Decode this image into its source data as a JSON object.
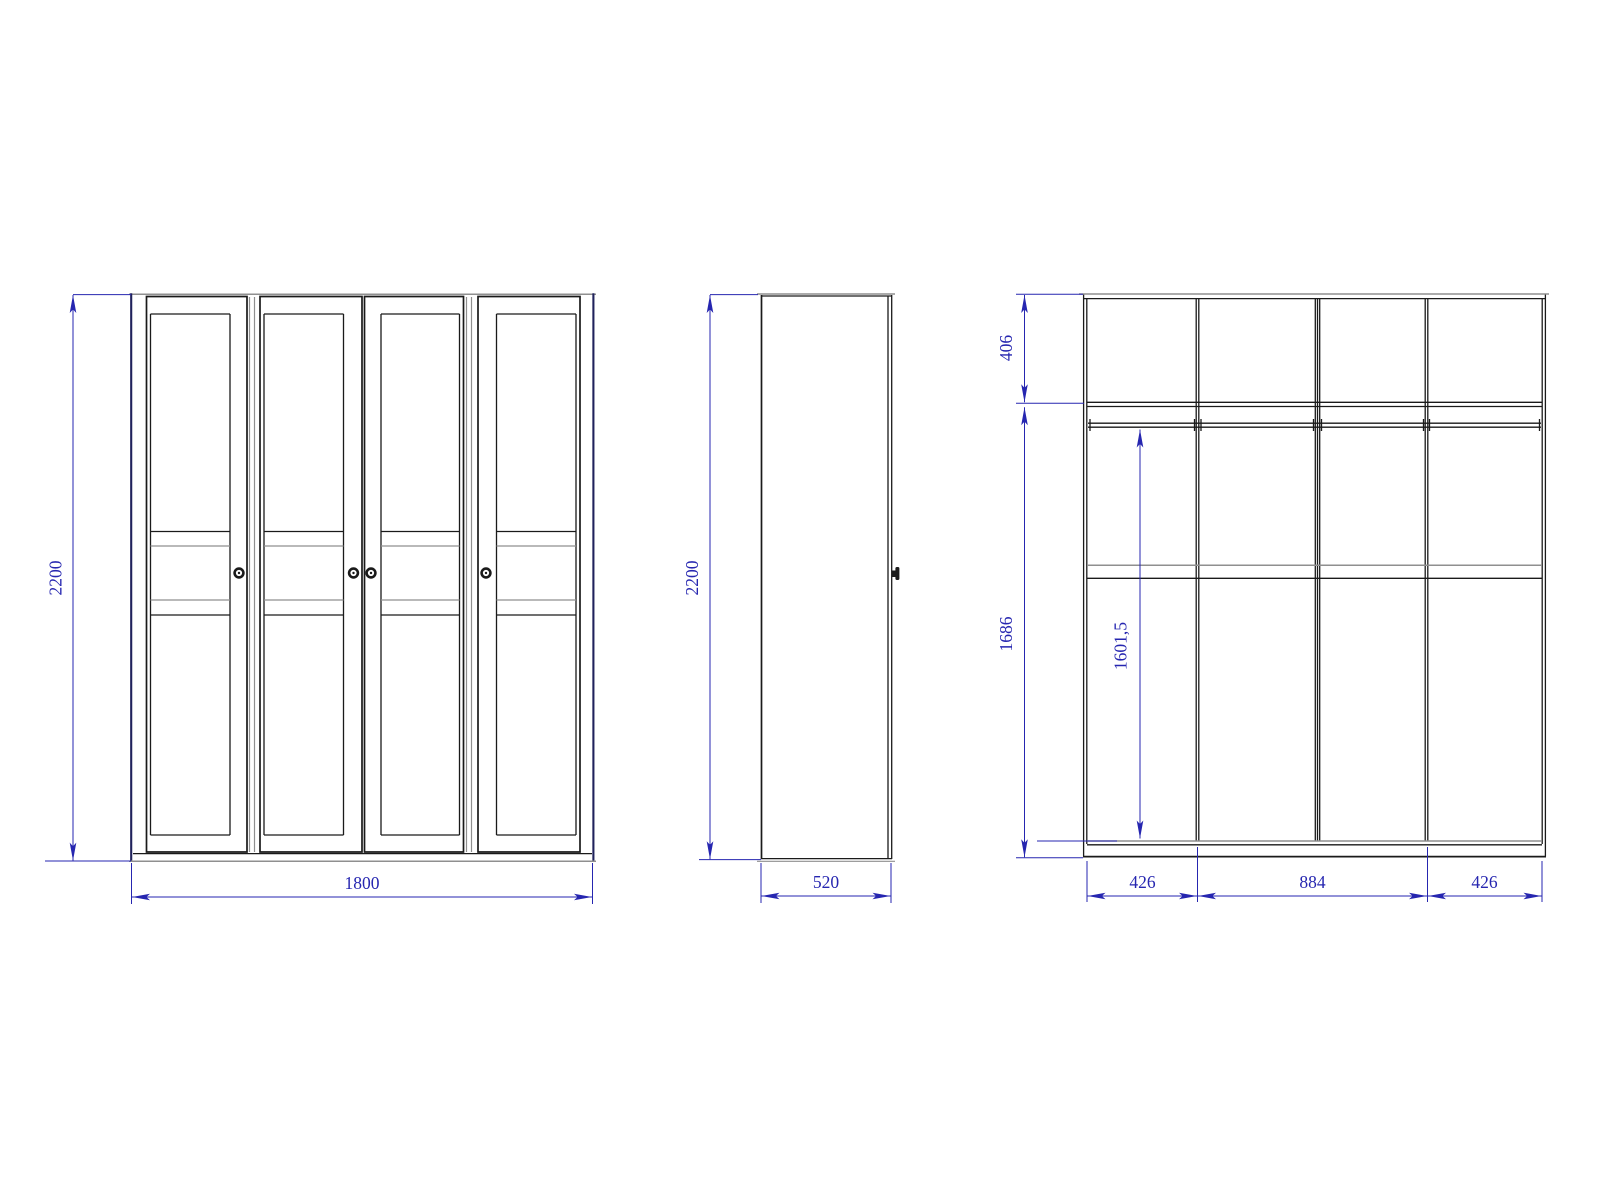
{
  "drawing": {
    "kind": "wardrobe-technical-drawing",
    "colors": {
      "line": "#1a1a1a",
      "carcass_edge": "#20225c",
      "secondary_line": "#8f8f8f",
      "dimension": "#2626b0",
      "background": "#ffffff"
    },
    "views": {
      "front": {
        "height": "2200",
        "width": "1800"
      },
      "side": {
        "height": "2200",
        "depth": "520"
      },
      "internal": {
        "top_section": "406",
        "body_section": "1686",
        "hanging_height": "1601,5",
        "columns": [
          "426",
          "884",
          "426"
        ]
      }
    }
  }
}
